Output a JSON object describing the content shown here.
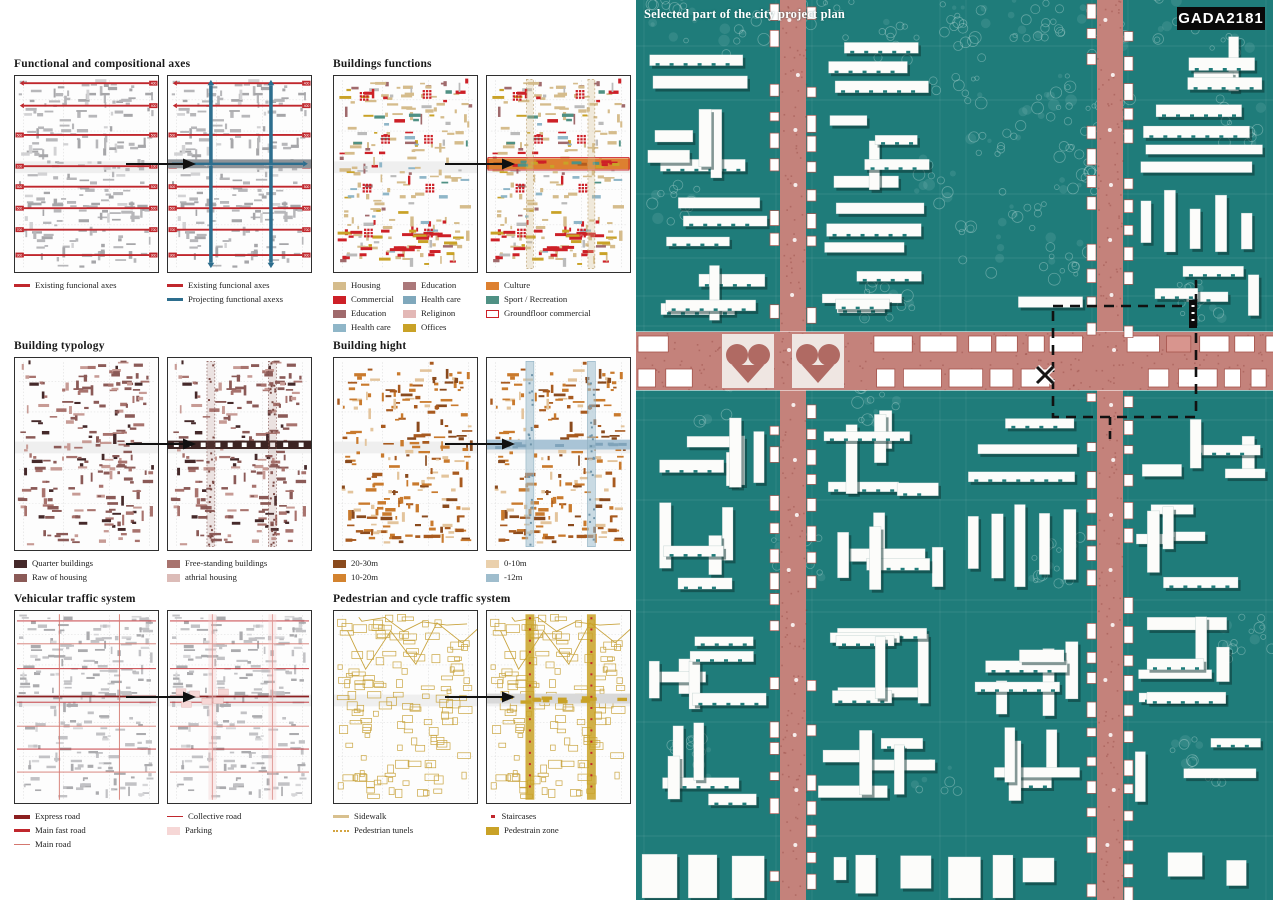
{
  "page": {
    "map_caption": "Selected part of the city project plan",
    "project_code": "GADA2181"
  },
  "colors": {
    "map_background": "#1f7c7a",
    "boulevard_pink": "#c4827b",
    "building_white": "#fcfcfa",
    "accent_red": "#c0272d",
    "accent_teal": "#2d6e8e",
    "selection_dash": "#111111"
  },
  "map": {
    "selection_marker": "X"
  },
  "sections": [
    {
      "id": "functional-axes",
      "title": "Functional and compositional axes",
      "axis_tags": [
        "400",
        "400",
        "500",
        "100",
        "500",
        "500",
        "700",
        "900"
      ],
      "band_labels": [
        "Sport",
        "Kultur"
      ],
      "legend_columns": [
        [
          {
            "label": "Existing funcional axes",
            "swatch": "line",
            "color": "#c0272d"
          }
        ],
        [
          {
            "label": "Existing funcional axes",
            "swatch": "line",
            "color": "#c0272d"
          },
          {
            "label": "Projecting functional axexs",
            "swatch": "line",
            "color": "#2d6e8e"
          }
        ]
      ]
    },
    {
      "id": "building-functions",
      "title": "Buildings functions",
      "legend_columns": [
        [
          {
            "label": "Housing",
            "swatch": "rect",
            "color": "#d5bc8c"
          },
          {
            "label": "Commercial",
            "swatch": "rect",
            "color": "#cd2027"
          },
          {
            "label": "Education",
            "swatch": "rect",
            "color": "#a06a6c"
          },
          {
            "label": "Health care",
            "swatch": "rect",
            "color": "#8fb6c8"
          }
        ],
        [
          {
            "label": "Education",
            "swatch": "rect",
            "color": "#ab787a"
          },
          {
            "label": "Health care",
            "swatch": "rect",
            "color": "#7fa8bc"
          },
          {
            "label": "Religinon",
            "swatch": "rect",
            "color": "#e3b8b6"
          },
          {
            "label": "Offices",
            "swatch": "rect",
            "color": "#c9a227"
          }
        ],
        [
          {
            "label": "Culture",
            "swatch": "rect",
            "color": "#dd8030"
          },
          {
            "label": "Sport / Recreation",
            "swatch": "rect",
            "color": "#4f9184"
          },
          {
            "label": "Groundfloor commercial",
            "swatch": "outline",
            "color": "#cd2027"
          }
        ]
      ]
    },
    {
      "id": "building-typology",
      "title": "Building typology",
      "legend_columns": [
        [
          {
            "label": "Quarter buildings",
            "swatch": "rect",
            "color": "#45292a"
          },
          {
            "label": "Raw of housing",
            "swatch": "rect",
            "color": "#8b5a57"
          }
        ],
        [
          {
            "label": "Free-standing buildings",
            "swatch": "rect",
            "color": "#a8736e"
          },
          {
            "label": "athrial housing",
            "swatch": "rect",
            "color": "#dcbcb8"
          }
        ]
      ]
    },
    {
      "id": "building-hight",
      "title": "Building hight",
      "legend_columns": [
        [
          {
            "label": "20-30m",
            "swatch": "rect",
            "color": "#8a4a1d"
          },
          {
            "label": "10-20m",
            "swatch": "rect",
            "color": "#d3832f"
          }
        ],
        [
          {
            "label": "0-10m",
            "swatch": "rect",
            "color": "#ead0ac"
          },
          {
            "label": "-12m",
            "swatch": "rect",
            "color": "#9fbdcd"
          }
        ]
      ]
    },
    {
      "id": "vehicular-traffic",
      "title": "Vehicular traffic system",
      "legend_columns": [
        [
          {
            "label": "Express road",
            "swatch": "line-thick",
            "color": "#8c1f20"
          },
          {
            "label": "Main fast road",
            "swatch": "line",
            "color": "#c0272d"
          },
          {
            "label": "Main road",
            "swatch": "line-thin",
            "color": "#d4776f"
          }
        ],
        [
          {
            "label": "Collective road",
            "swatch": "line-thin",
            "color": "#c0272d"
          },
          {
            "label": "Parking",
            "swatch": "rect",
            "color": "#f6d7d6"
          }
        ]
      ]
    },
    {
      "id": "pedestrian-cycle",
      "title": "Pedestrian and cycle traffic system",
      "legend_columns": [
        [
          {
            "label": "Sidewalk",
            "swatch": "line",
            "color": "#d8c08e"
          },
          {
            "label": "Pedestrian tunels",
            "swatch": "line-dotted",
            "color": "#d3a441"
          }
        ],
        [
          {
            "label": "Staircases",
            "swatch": "dot",
            "color": "#c0272d"
          },
          {
            "label": "Pedestrain zone",
            "swatch": "rect",
            "color": "#c9a227"
          }
        ]
      ]
    }
  ]
}
